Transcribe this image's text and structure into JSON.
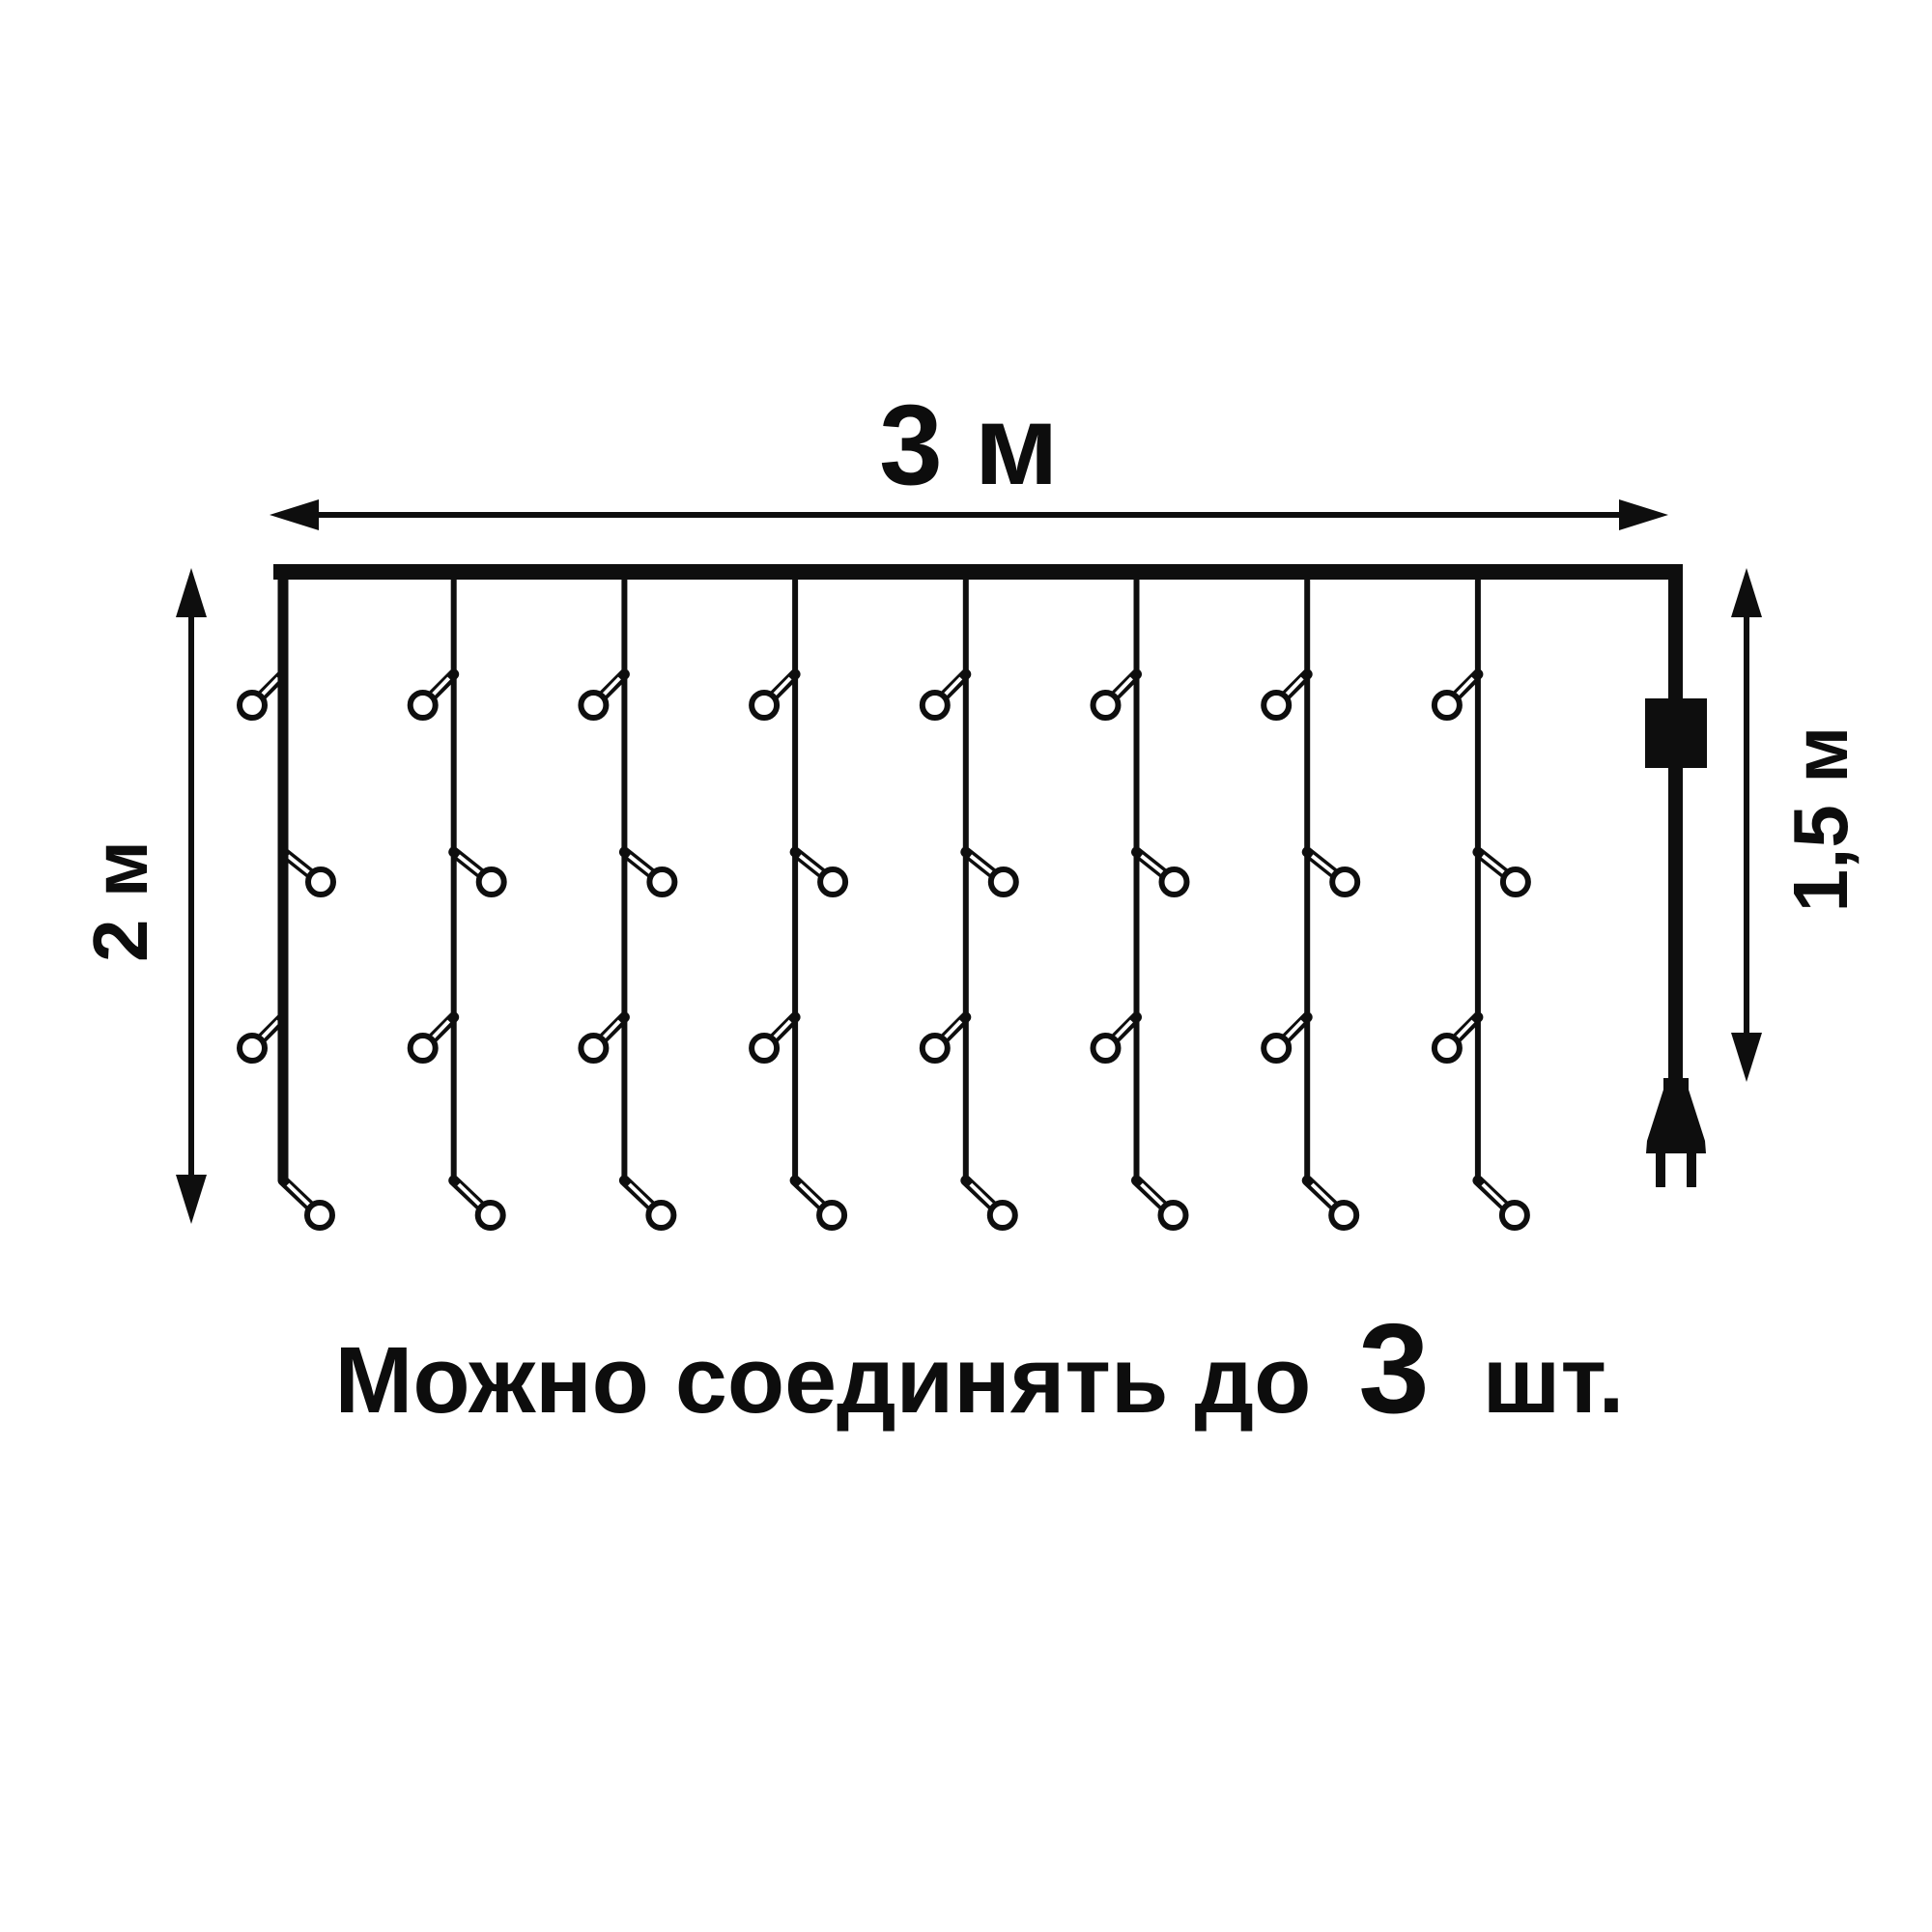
{
  "background": "#ffffff",
  "line_color": "#0e0e0e",
  "diagram": {
    "title": "icicle curtain light dimensions",
    "width_label": "3 м",
    "height_label": "2 м",
    "drop_label": "1,5 м",
    "strand_count": 8,
    "bulbs_per_strand": 4
  },
  "note": {
    "prefix": "Можно соединять до",
    "count": "3",
    "suffix": "шт."
  }
}
